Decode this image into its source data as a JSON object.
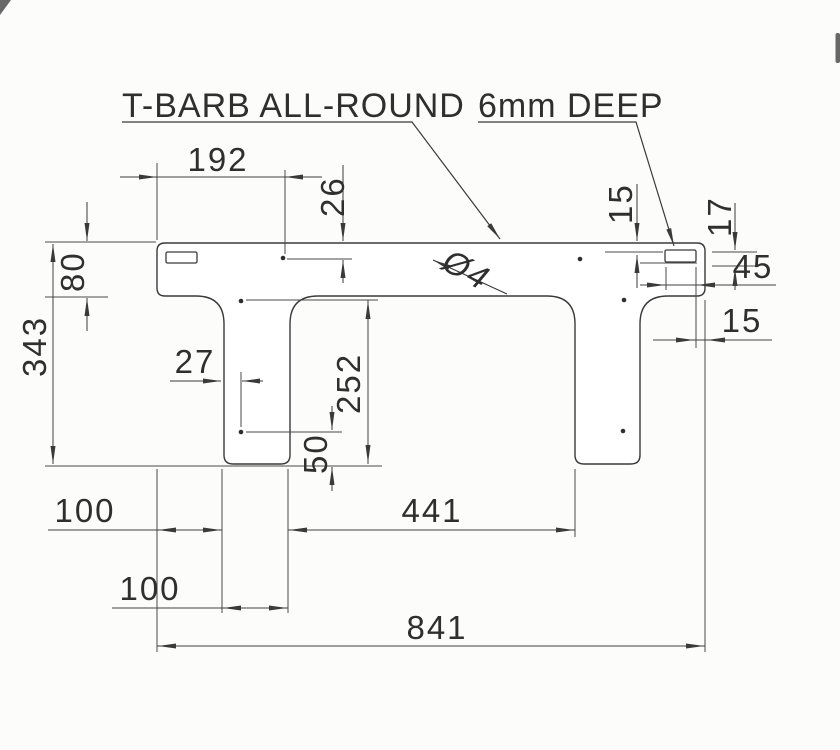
{
  "drawing": {
    "callouts": {
      "t_barb": "T-BARB ALL-ROUND",
      "deep": "6mm DEEP",
      "hole_diameter": "Ø4"
    },
    "dimensions": {
      "hole_from_left": "192",
      "hole_from_top": "26",
      "rail_height": "80",
      "total_height": "343",
      "hole_from_leg_edge": "27",
      "leg_inner_height": "252",
      "hole_to_leg_bottom": "50",
      "left_offset": "100",
      "leg_width": "100",
      "leg_gap": "441",
      "total_width": "841",
      "right_hole_from_top": "15",
      "right_slot_from_top": "17",
      "right_slot_width": "45",
      "right_slot_to_edge": "15"
    },
    "colors": {
      "line": "#3a3a3a",
      "background": "#fcfcfb"
    }
  }
}
